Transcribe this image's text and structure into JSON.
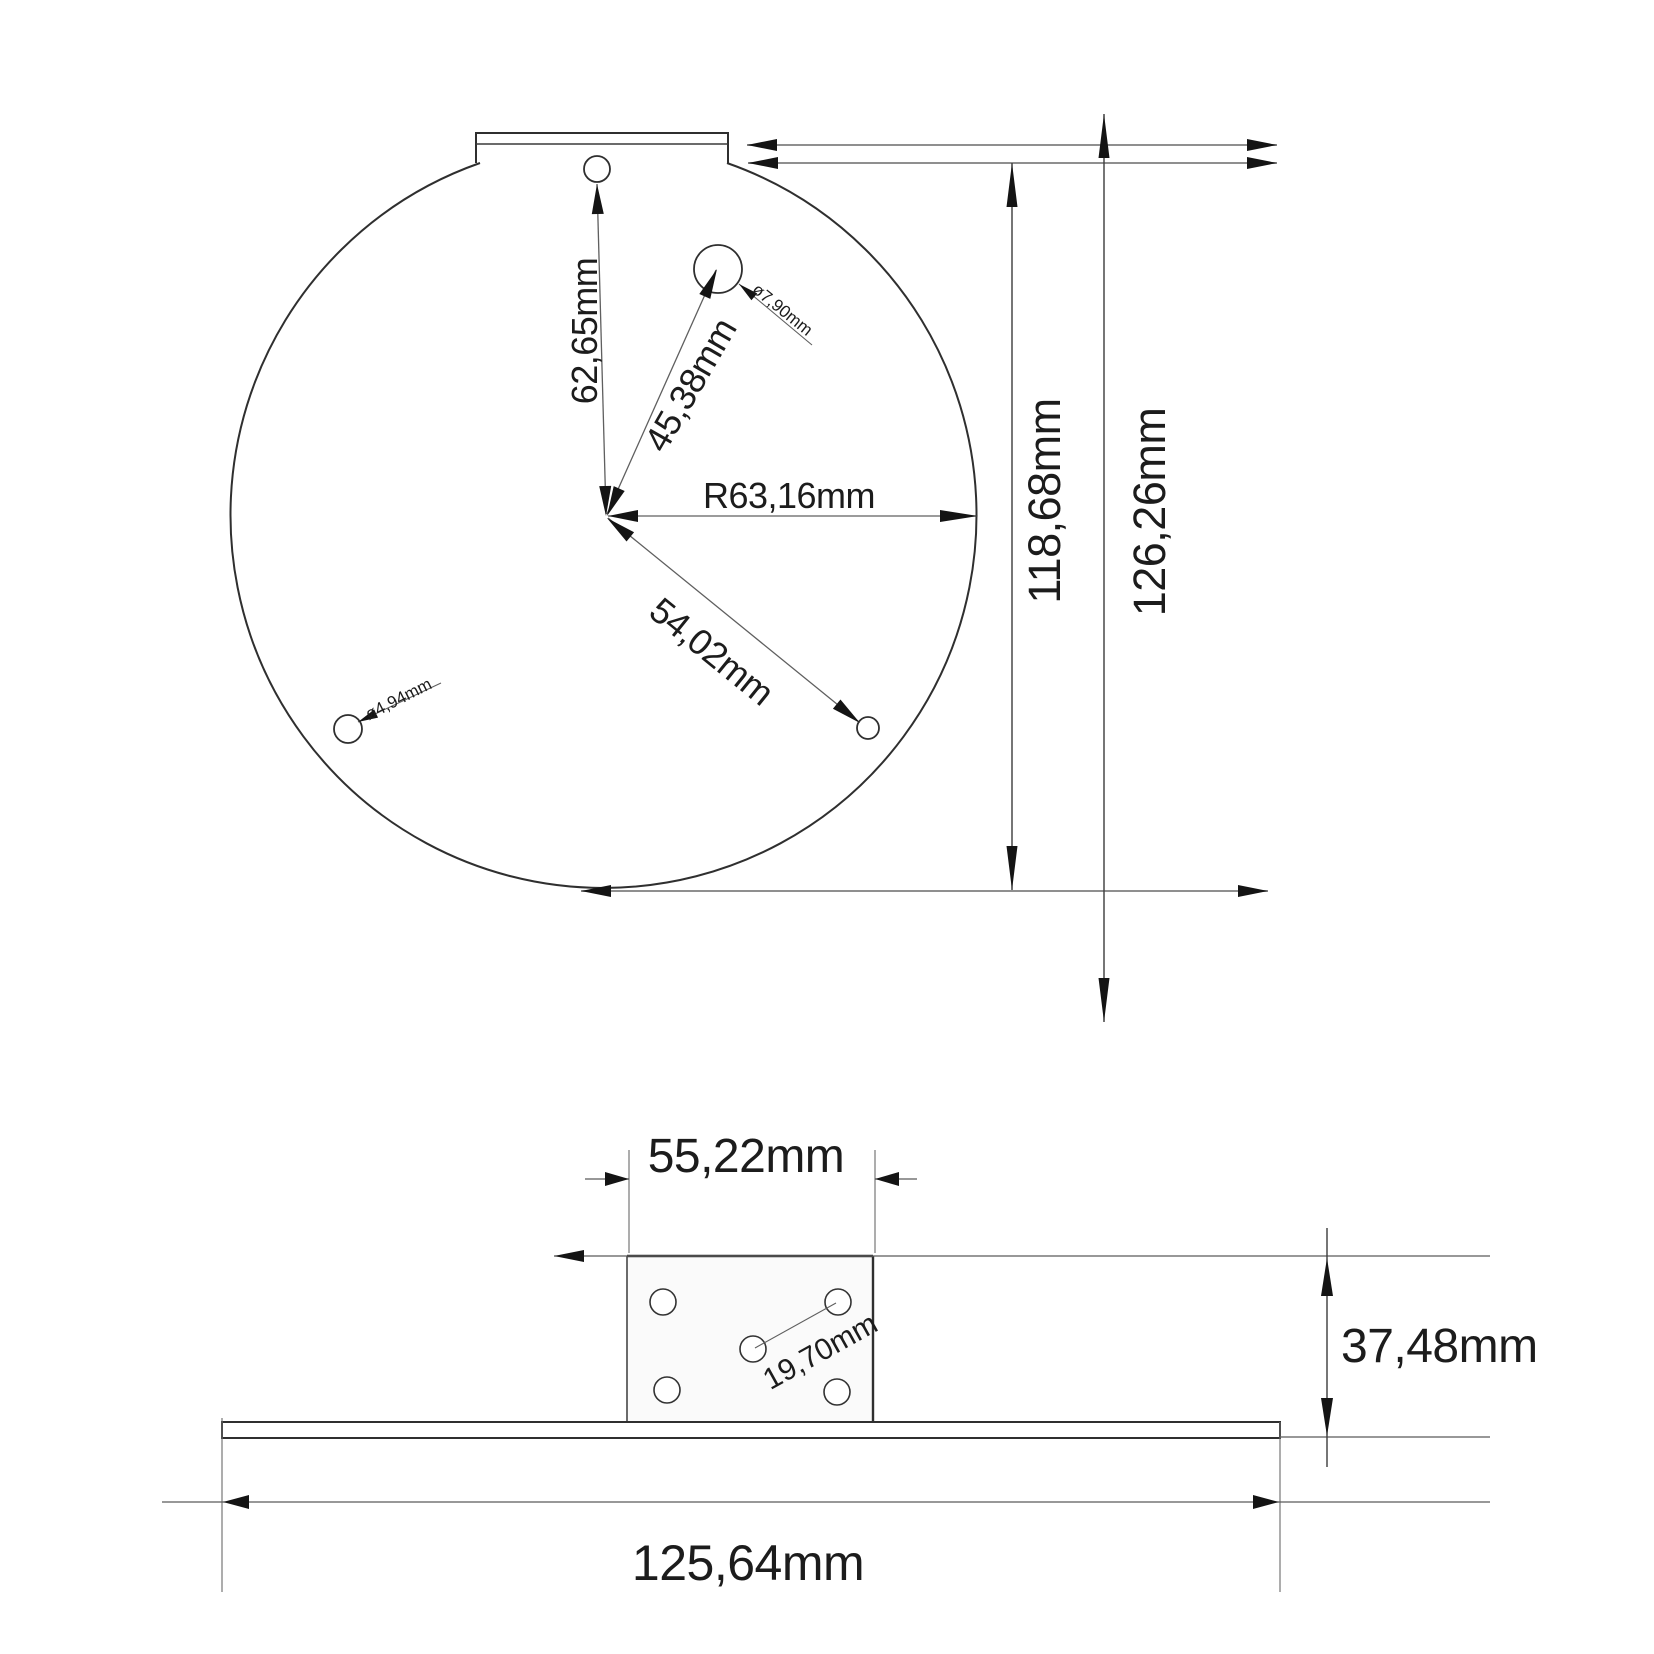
{
  "colors": {
    "background": "#ffffff",
    "line": "#2f2f2f",
    "dimension_line": "#5f5f5f",
    "reference_line": "#8f8f8f",
    "text": "#1c1c1c",
    "arrow": "#141414"
  },
  "top_view": {
    "hole_offset_vertical": "62,65mm",
    "hole_offset_diagonal": "45,38mm",
    "radius": "R63,16mm",
    "hole_offset_lower": "54,02mm",
    "hole_diameter_large": "ø7,90mm",
    "hole_diameter_small": "ø4,94mm",
    "height_flat_to_bottom": "118,68mm",
    "height_total": "126,26mm"
  },
  "front_view": {
    "block_width": "55,22mm",
    "hole_spacing": "19,70mm",
    "block_height": "37,48mm",
    "base_width": "125,64mm"
  }
}
